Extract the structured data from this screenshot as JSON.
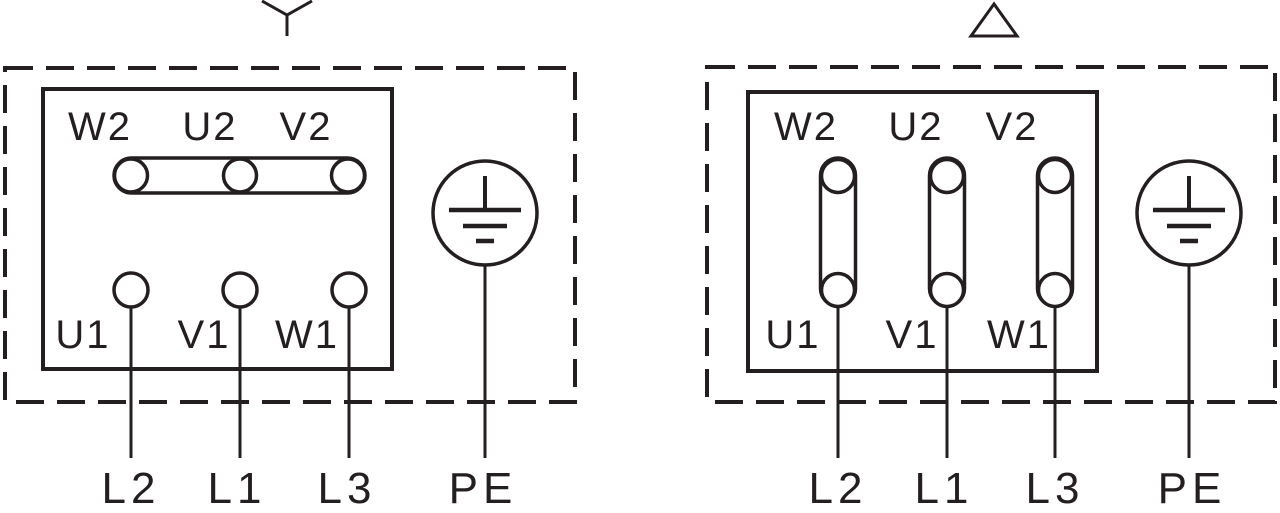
{
  "colors": {
    "ink": "#231f20",
    "bg": "#ffffff"
  },
  "star_diagram": {
    "connection_symbol": "wye",
    "top_terminals": [
      "W2",
      "U2",
      "V2"
    ],
    "bottom_terminals": [
      "U1",
      "V1",
      "W1"
    ],
    "line_labels": [
      "L2",
      "L1",
      "L3"
    ],
    "earth_label": "PE"
  },
  "delta_diagram": {
    "connection_symbol": "delta",
    "top_terminals": [
      "W2",
      "U2",
      "V2"
    ],
    "bottom_terminals": [
      "U1",
      "V1",
      "W1"
    ],
    "line_labels": [
      "L2",
      "L1",
      "L3"
    ],
    "earth_label": "PE"
  }
}
